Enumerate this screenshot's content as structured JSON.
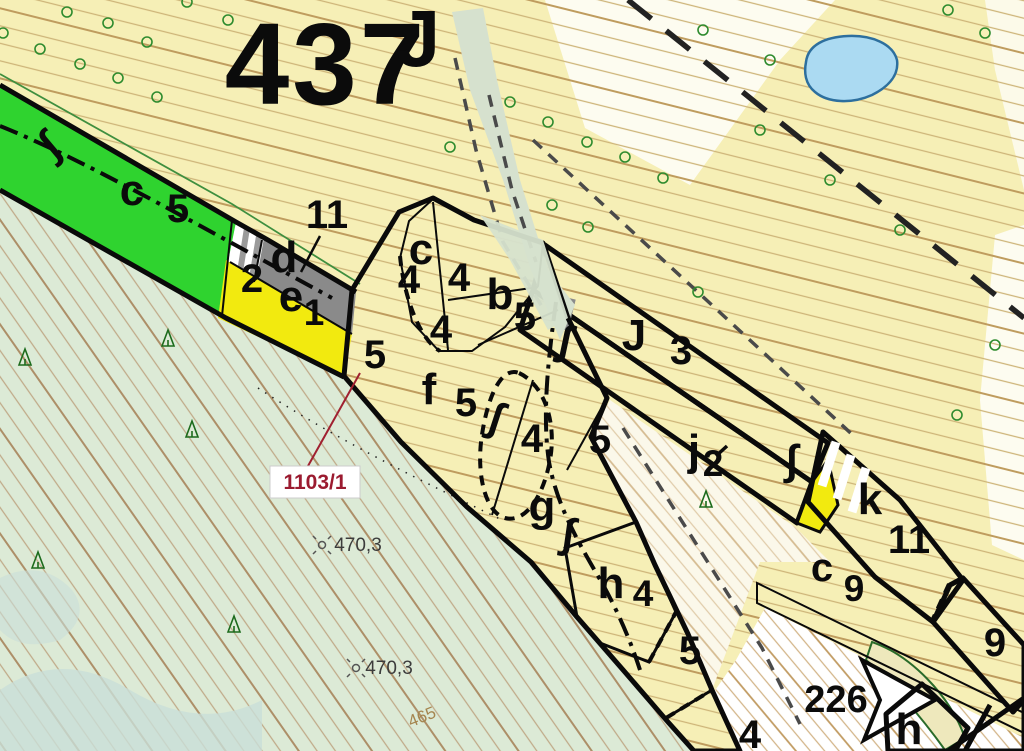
{
  "map": {
    "stand": {
      "number": "437",
      "suffix": "J"
    },
    "parcels": {
      "c5": {
        "letter": "c",
        "num": "5"
      },
      "d": {
        "ref": "11",
        "letter": "d"
      },
      "e1": {
        "prefix": "2",
        "letter": "e",
        "num": "1"
      },
      "c4": {
        "letter": "c",
        "n_left": "4",
        "n_right": "4",
        "n_bottom": "4"
      },
      "b5": {
        "letter": "b",
        "num": "5"
      },
      "f5": {
        "letter": "f",
        "num": "5",
        "num_left": "5"
      },
      "gap4": {
        "num": "4"
      },
      "g": {
        "letter": "g",
        "num_right": "5"
      },
      "h4": {
        "letter": "h",
        "num": "4"
      },
      "s5": {
        "num": "5"
      },
      "s4": {
        "num": "4"
      },
      "J3": {
        "letter": "J",
        "num": "3"
      },
      "j2": {
        "letter": "j",
        "num": "2"
      },
      "k11": {
        "letter": "k",
        "num": "11"
      },
      "c9": {
        "letter": "c",
        "num": "9"
      },
      "brown9": {
        "num": "9"
      },
      "h_se": {
        "letter": "h"
      }
    },
    "annotations": {
      "cadastral": "1103/1",
      "area_ref": "226",
      "spot_height_1": "470,3",
      "spot_height_2": "470,3",
      "contour_label": "465",
      "stream_glyph": "∫"
    },
    "colors": {
      "bg_yellow": "#f6efb6",
      "white": "#ffffff",
      "forest_bg": "#dcead6",
      "teal_patch": "#c9ded8",
      "wedge": "#d6e1ce",
      "parcel_green": "#2fd32f",
      "parcel_red": "#ea1512",
      "parcel_yellow": "#f2ea0f",
      "parcel_gray": "#8a8a8a",
      "parcel_brown": "#a6791f",
      "pond_fill": "#abdaf2",
      "pond_stroke": "#2d6f9e",
      "blob_band": "#eee8bc",
      "cadastral_red": "#9b1b30",
      "tree_green": "#2e8b2e",
      "white_soft": "#fbf8ea"
    }
  }
}
